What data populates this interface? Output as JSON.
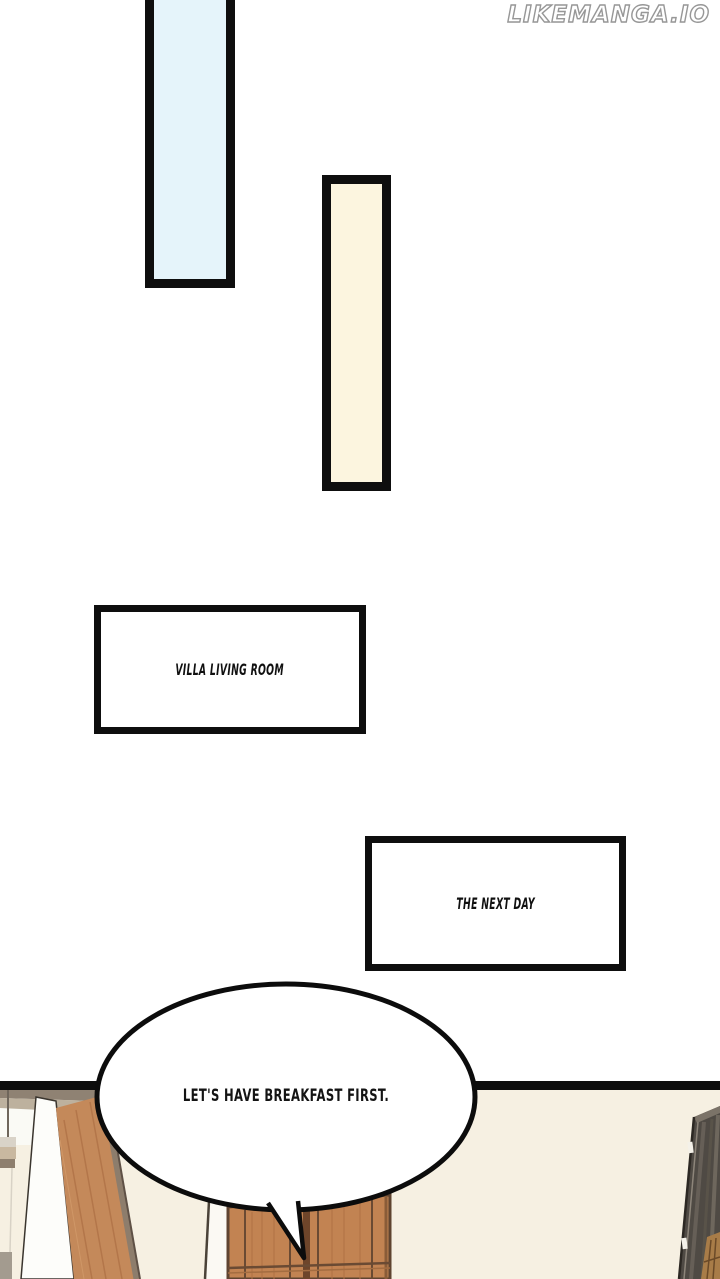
{
  "watermark": {
    "text": "LIKEMANGA.IO"
  },
  "panels": {
    "top": {
      "blue_bar_color": "#e5f4fa",
      "cream_bar_color": "#fcf5df"
    },
    "captions": {
      "villa": "VILLA LIVING ROOM",
      "next_day": "THE NEXT DAY"
    }
  },
  "speech_bubble": {
    "text": "LET'S HAVE BREAKFAST FIRST."
  },
  "scene": {
    "wall_color": "#f6f0e2",
    "shelf_strip_color": "#8f8273",
    "shelf_strip_light_color": "#bdb19e",
    "wardrobe_white_door_color": "#fdfdfa",
    "wardrobe_plank_color": "#c4895a",
    "door_wood_color": "#c28352",
    "door_line_color": "#6a4a33",
    "dark_door_color": "#4f4a44",
    "panel_border_color": "#0d0d0d"
  }
}
